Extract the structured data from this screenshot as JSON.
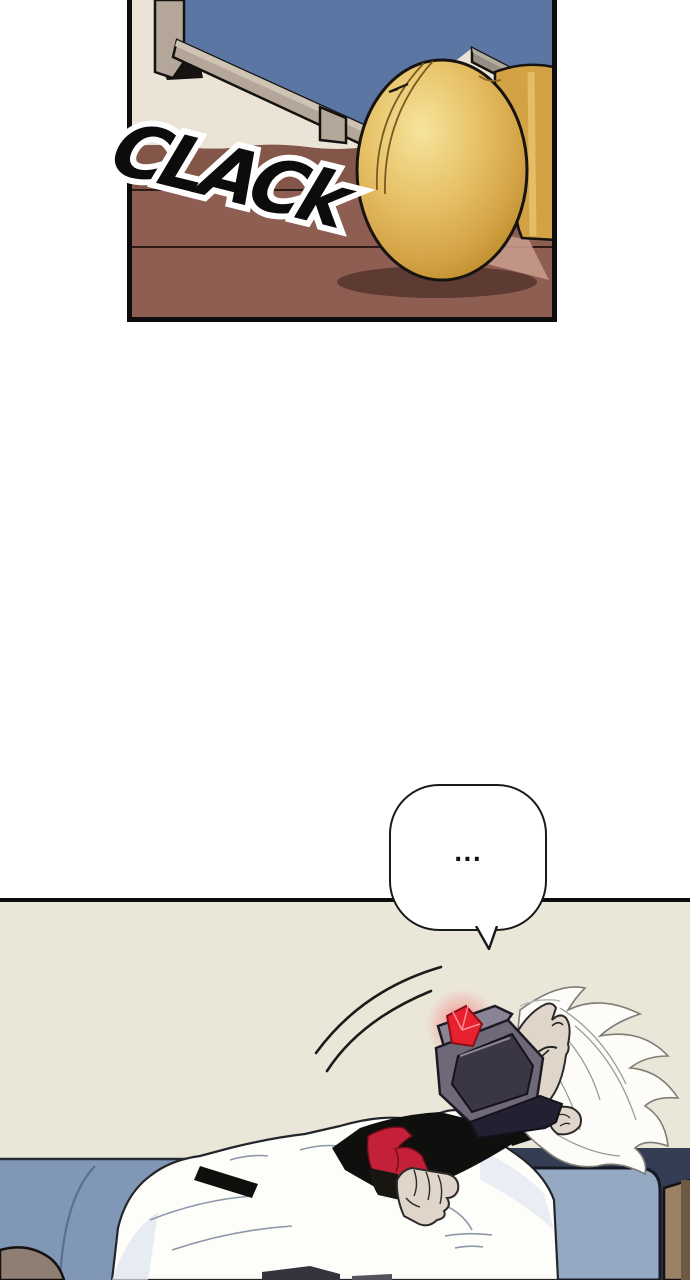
{
  "page": {
    "width": 690,
    "height": 1280,
    "kind": "webtoon-comic-page"
  },
  "panel_top": {
    "sfx": "CLACk",
    "scene": "close-up of brass door knob by a wooden floor, blue door panel behind"
  },
  "speech_bubble": {
    "text": "..."
  },
  "panel_bottom": {
    "scene": "white-haired person asleep on blue couch wearing dark visor with glowing red gem"
  },
  "colors": {
    "pageBg": "#ffffff",
    "ink": "#0d0d0d",
    "sfxInk": "#0c0c0c",
    "outlineWhite": "#ffffff",
    "panelBlue": "#5b76a3",
    "frameTan": "#b4a79a",
    "frameTanLight": "#cfc4b4",
    "frameGrey": "#978e84",
    "wallCream": "#ebe3d5",
    "floorBrown": "#8f5e53",
    "floorBrownDark": "#845549",
    "floorShadow": "#5d3a32",
    "floorPink": "#c69a8b",
    "knobShaft": "#d3a245",
    "wallBeige": "#eae6d8",
    "couchBlue": "#8197b6",
    "couchArm": "#95aac2",
    "couchDark": "#353d55",
    "cushionGrey": "#8e7e74",
    "woodBrown": "#9b8165",
    "woodDark": "#6e5942",
    "hairWhite": "#fdfcf9",
    "skin": "#dfd5c9",
    "jacketWhite": "#fdfdfa",
    "jacketShade": "#dde2ee",
    "shirtBlack": "#0f0f0e",
    "tieRed": "#c5203a",
    "visorShell": "#6e6879",
    "visorShellLight": "#8a8496",
    "visorScreen": "#3a3646",
    "visorStrap": "#232031",
    "gemRed": "#e8212f"
  }
}
